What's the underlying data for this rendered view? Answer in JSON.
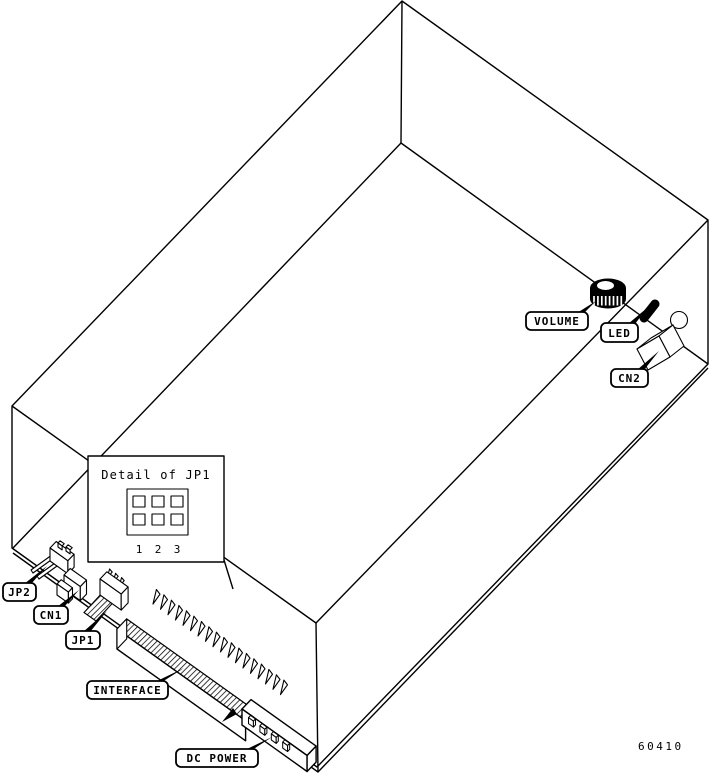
{
  "diagram": {
    "drawing_number": "60410",
    "inset": {
      "title": "Detail of JP1",
      "pin_labels": [
        "1",
        "2",
        "3"
      ]
    },
    "labels": {
      "jp2": "JP2",
      "cn1": "CN1",
      "jp1": "JP1",
      "interface": "INTERFACE",
      "dc_power": "DC POWER",
      "volume": "VOLUME",
      "led": "LED",
      "cn2": "CN2"
    },
    "colors": {
      "line": "#000000",
      "background": "#ffffff"
    }
  }
}
